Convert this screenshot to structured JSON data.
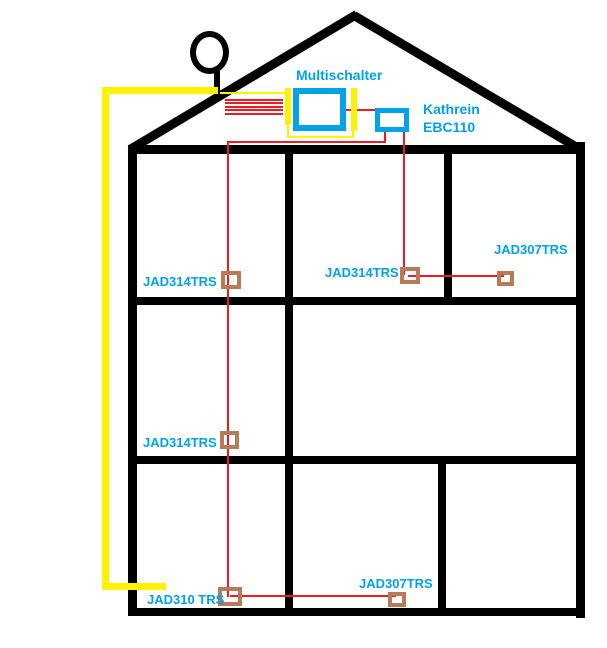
{
  "colors": {
    "structure": "#000000",
    "sat_cable": "#FFF200",
    "coax_cable": "#ED1C24",
    "device": "#00A2E8",
    "label_text": "#00A2E8",
    "outlet": "#B97A57",
    "background": "#FFFFFF"
  },
  "devices": {
    "multischalter": {
      "label": "Multischalter"
    },
    "kathrein": {
      "label": "Kathrein",
      "model": "EBC110"
    }
  },
  "outlets": {
    "floor1_left": {
      "label": "JAD314TRS"
    },
    "floor1_mid": {
      "label": "JAD314TRS"
    },
    "floor1_right": {
      "label": "JAD307TRS"
    },
    "floor2_left": {
      "label": "JAD314TRS"
    },
    "floor3_left": {
      "label": "JAD310 TRS"
    },
    "floor3_right": {
      "label": "JAD307TRS"
    }
  }
}
